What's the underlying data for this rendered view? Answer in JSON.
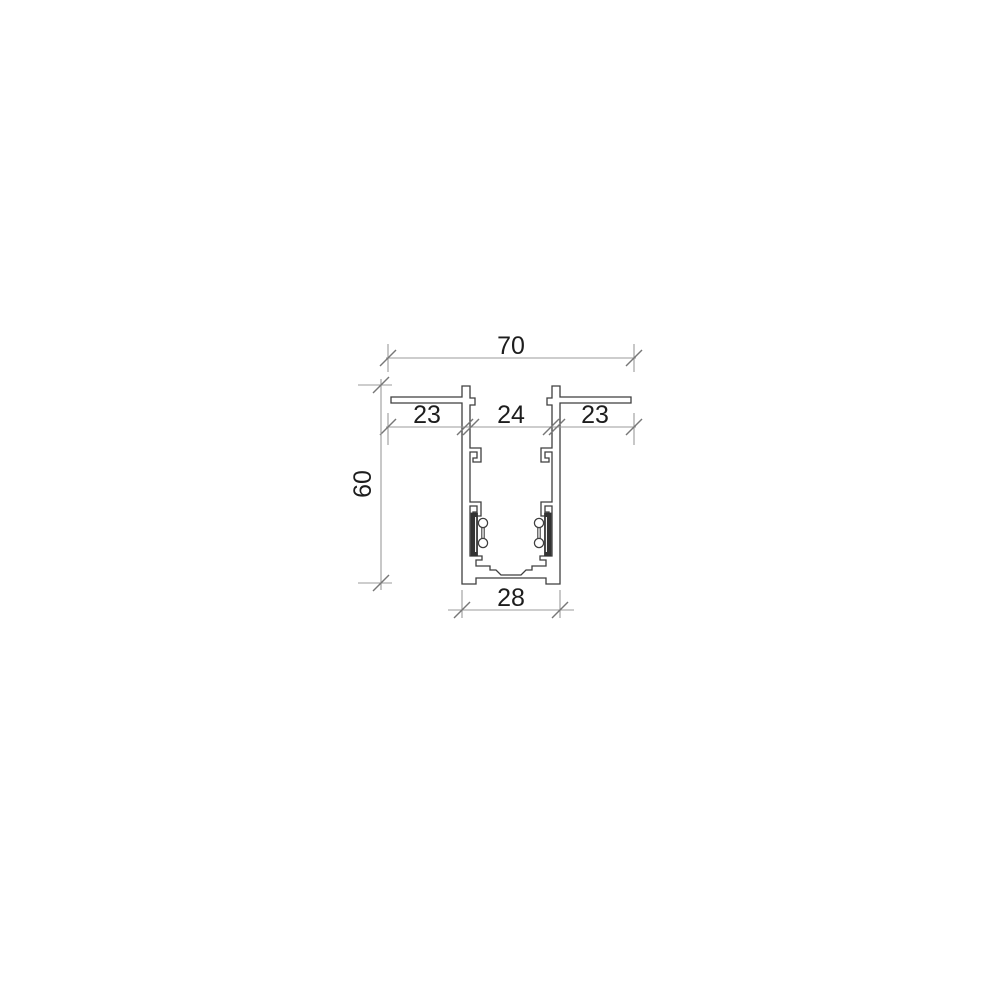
{
  "drawing": {
    "description": "Technical cross-section drawing of a recessed track profile with dimension annotations",
    "dimensions": {
      "top_width": "70",
      "left_segment": "23",
      "center_segment": "24",
      "right_segment": "23",
      "height": "60",
      "bottom_width": "28"
    },
    "colors": {
      "background": "#ffffff",
      "profile_line": "#3f3f3f",
      "dimension_line": "#9b9b9b",
      "tick_mark": "#777777",
      "text": "#1d1d1d",
      "contact_insulator_fill": "#333333"
    }
  }
}
